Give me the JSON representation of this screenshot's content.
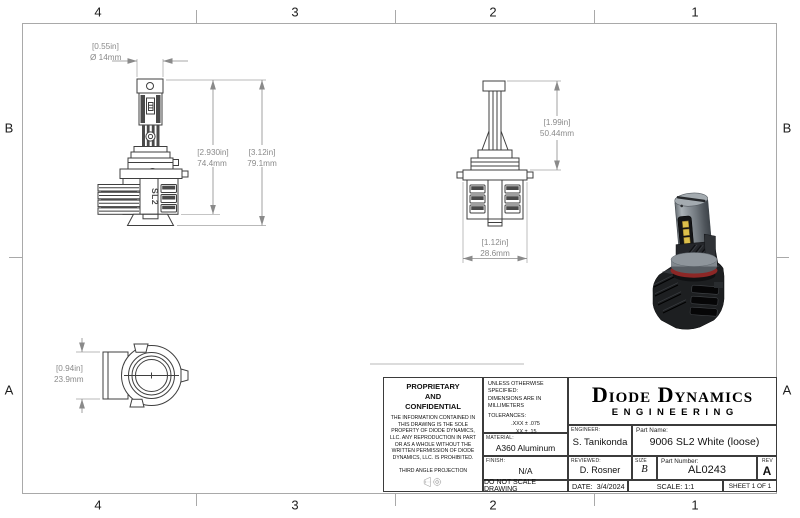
{
  "zones": {
    "top": [
      "4",
      "3",
      "2",
      "1"
    ],
    "bottom": [
      "4",
      "3",
      "2",
      "1"
    ],
    "left": [
      "B",
      "A"
    ],
    "right": [
      "B",
      "A"
    ]
  },
  "views": {
    "front": {
      "logo_text": "SL2",
      "dims": {
        "dia_in": "[0.55in]",
        "dia_mm": "Ø 14mm",
        "h1_in": "[2.930in]",
        "h1_mm": "74.4mm",
        "h2_in": "[3.12in]",
        "h2_mm": "79.1mm"
      }
    },
    "side": {
      "dims": {
        "h_in": "[1.99in]",
        "h_mm": "50.44mm",
        "w_in": "[1.12in]",
        "w_mm": "28.6mm"
      }
    },
    "bottom": {
      "dims": {
        "h_in": "[0.94in]",
        "h_mm": "23.9mm"
      }
    }
  },
  "render": {
    "colors": {
      "ring_red": "#8c2726",
      "chip_yellow": "#dcbf4b",
      "base_black": "#1d1f21",
      "body_gray": "#8a9096"
    }
  },
  "title_block": {
    "proprietary_title": "PROPRIETARY\nAND\nCONFIDENTIAL",
    "proprietary_body": "THE INFORMATION CONTAINED IN THIS DRAWING IS THE SOLE PROPERTY OF DIODE DYNAMICS, LLC.  ANY REPRODUCTION IN PART OR AS A WHOLE WITHOUT THE WRITTEN PERMISSION OF DIODE DYNAMICS, LLC. IS PROHIBITED.",
    "projection_label": "THIRD ANGLE PROJECTION",
    "unless": "UNLESS OTHERWISE SPECIFIED:",
    "dims_units": "DIMENSIONS ARE IN MILLIMETERS",
    "tolerances_label": "TOLERANCES:",
    "tolerances": [
      ".XXX ± .075",
      ".XX ± .15",
      ".X ± .3",
      "± .5",
      "ANG ± 1"
    ],
    "material_label": "MATERIAL:",
    "material": "A360 Aluminum",
    "finish_label": "FINISH:",
    "finish": "N/A",
    "do_not_scale": "DO NOT SCALE DRAWING",
    "company_name": "Diode Dynamics",
    "company_sub": "ENGINEERING",
    "engineer_label": "ENGINEER:",
    "engineer": "S. Tanikonda",
    "reviewed_label": "REVIEWED:",
    "reviewed": "D. Rosner",
    "part_name_label": "Part Name:",
    "part_name": "9006 SL2 White (loose)",
    "size_label": "SIZE",
    "size": "B",
    "part_number_label": "Part Number:",
    "part_number": "AL0243",
    "rev_label": "REV",
    "rev": "A",
    "date_label": "DATE:",
    "date": "3/4/2024",
    "scale": "SCALE: 1:1",
    "sheet": "SHEET 1 OF 1"
  }
}
